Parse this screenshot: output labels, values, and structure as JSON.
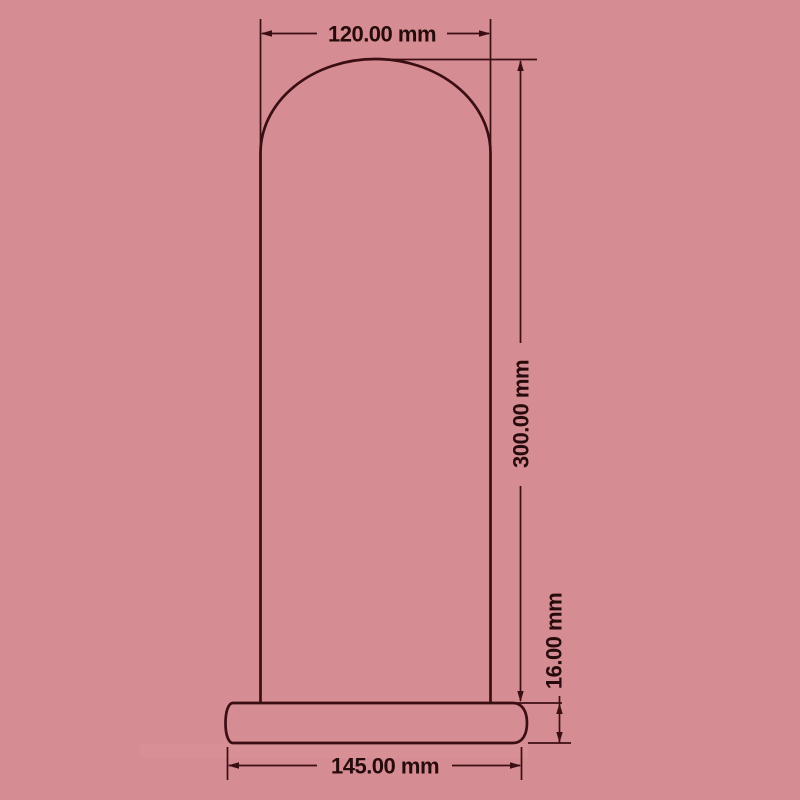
{
  "drawing": {
    "type": "dimensioned-technical-drawing",
    "unit": "mm",
    "shapes": [
      "dome-cover-outline",
      "base-plate-outline"
    ],
    "dimensions": {
      "top_width": {
        "label": "120.00 mm",
        "value": 120,
        "unit": "mm",
        "orientation": "horizontal"
      },
      "overall_height": {
        "label": "300.00 mm",
        "value": 300,
        "unit": "mm",
        "orientation": "vertical"
      },
      "base_thickness": {
        "label": "16.00 mm",
        "value": 16,
        "unit": "mm",
        "orientation": "vertical"
      },
      "base_width": {
        "label": "145.00 mm",
        "value": 145,
        "unit": "mm",
        "orientation": "horizontal"
      }
    },
    "colors": {
      "background": "#d58c92",
      "line": "#3a0e13",
      "text": "#260a0c"
    }
  }
}
